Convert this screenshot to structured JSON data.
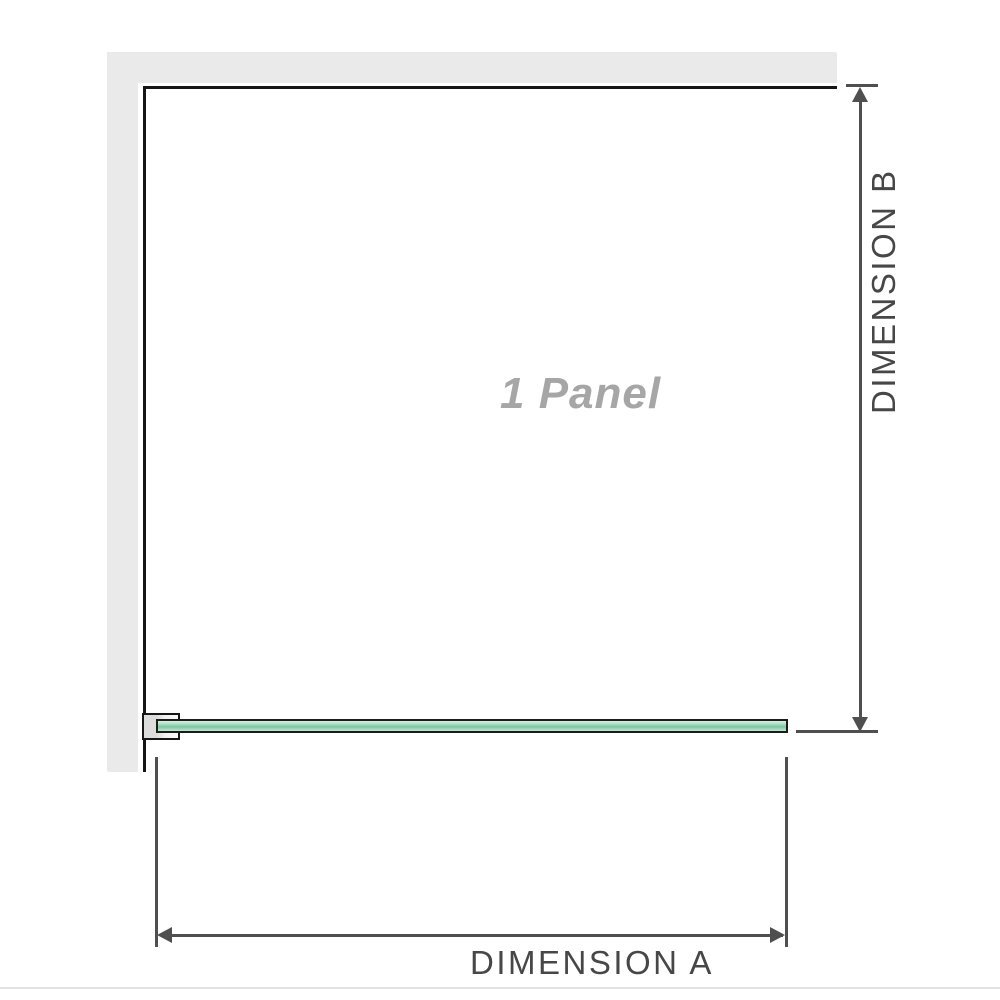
{
  "diagram": {
    "panel_label": "1 Panel",
    "dimension_a": {
      "label": "DIMENSION A"
    },
    "dimension_b": {
      "label": "DIMENSION B"
    }
  },
  "colors": {
    "background": "#ffffff",
    "wall": "#eaeaea",
    "frame": "#161616",
    "dim_line": "#4f4f4f",
    "dim_text": "#474747",
    "panel_text": "#a6a6a6",
    "glass_top": "#d8f1e2",
    "glass_mid": "#7fc6a0",
    "glass_bottom": "#bfe8d2",
    "glass_border": "#1c1c1c",
    "divider": "#e2e2df"
  }
}
